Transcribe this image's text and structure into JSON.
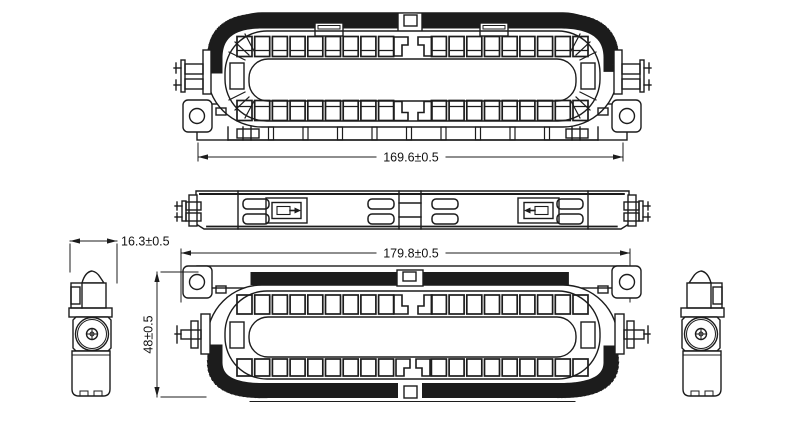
{
  "drawing": {
    "type": "engineering-drawing",
    "background_color": "#ffffff",
    "line_color": "#1c1c1c",
    "dimensions": {
      "top_width": "169.6±0.5",
      "overall_width": "179.8±0.5",
      "overall_height": "48±0.5",
      "end_view_width": "16.3±0.5"
    }
  }
}
